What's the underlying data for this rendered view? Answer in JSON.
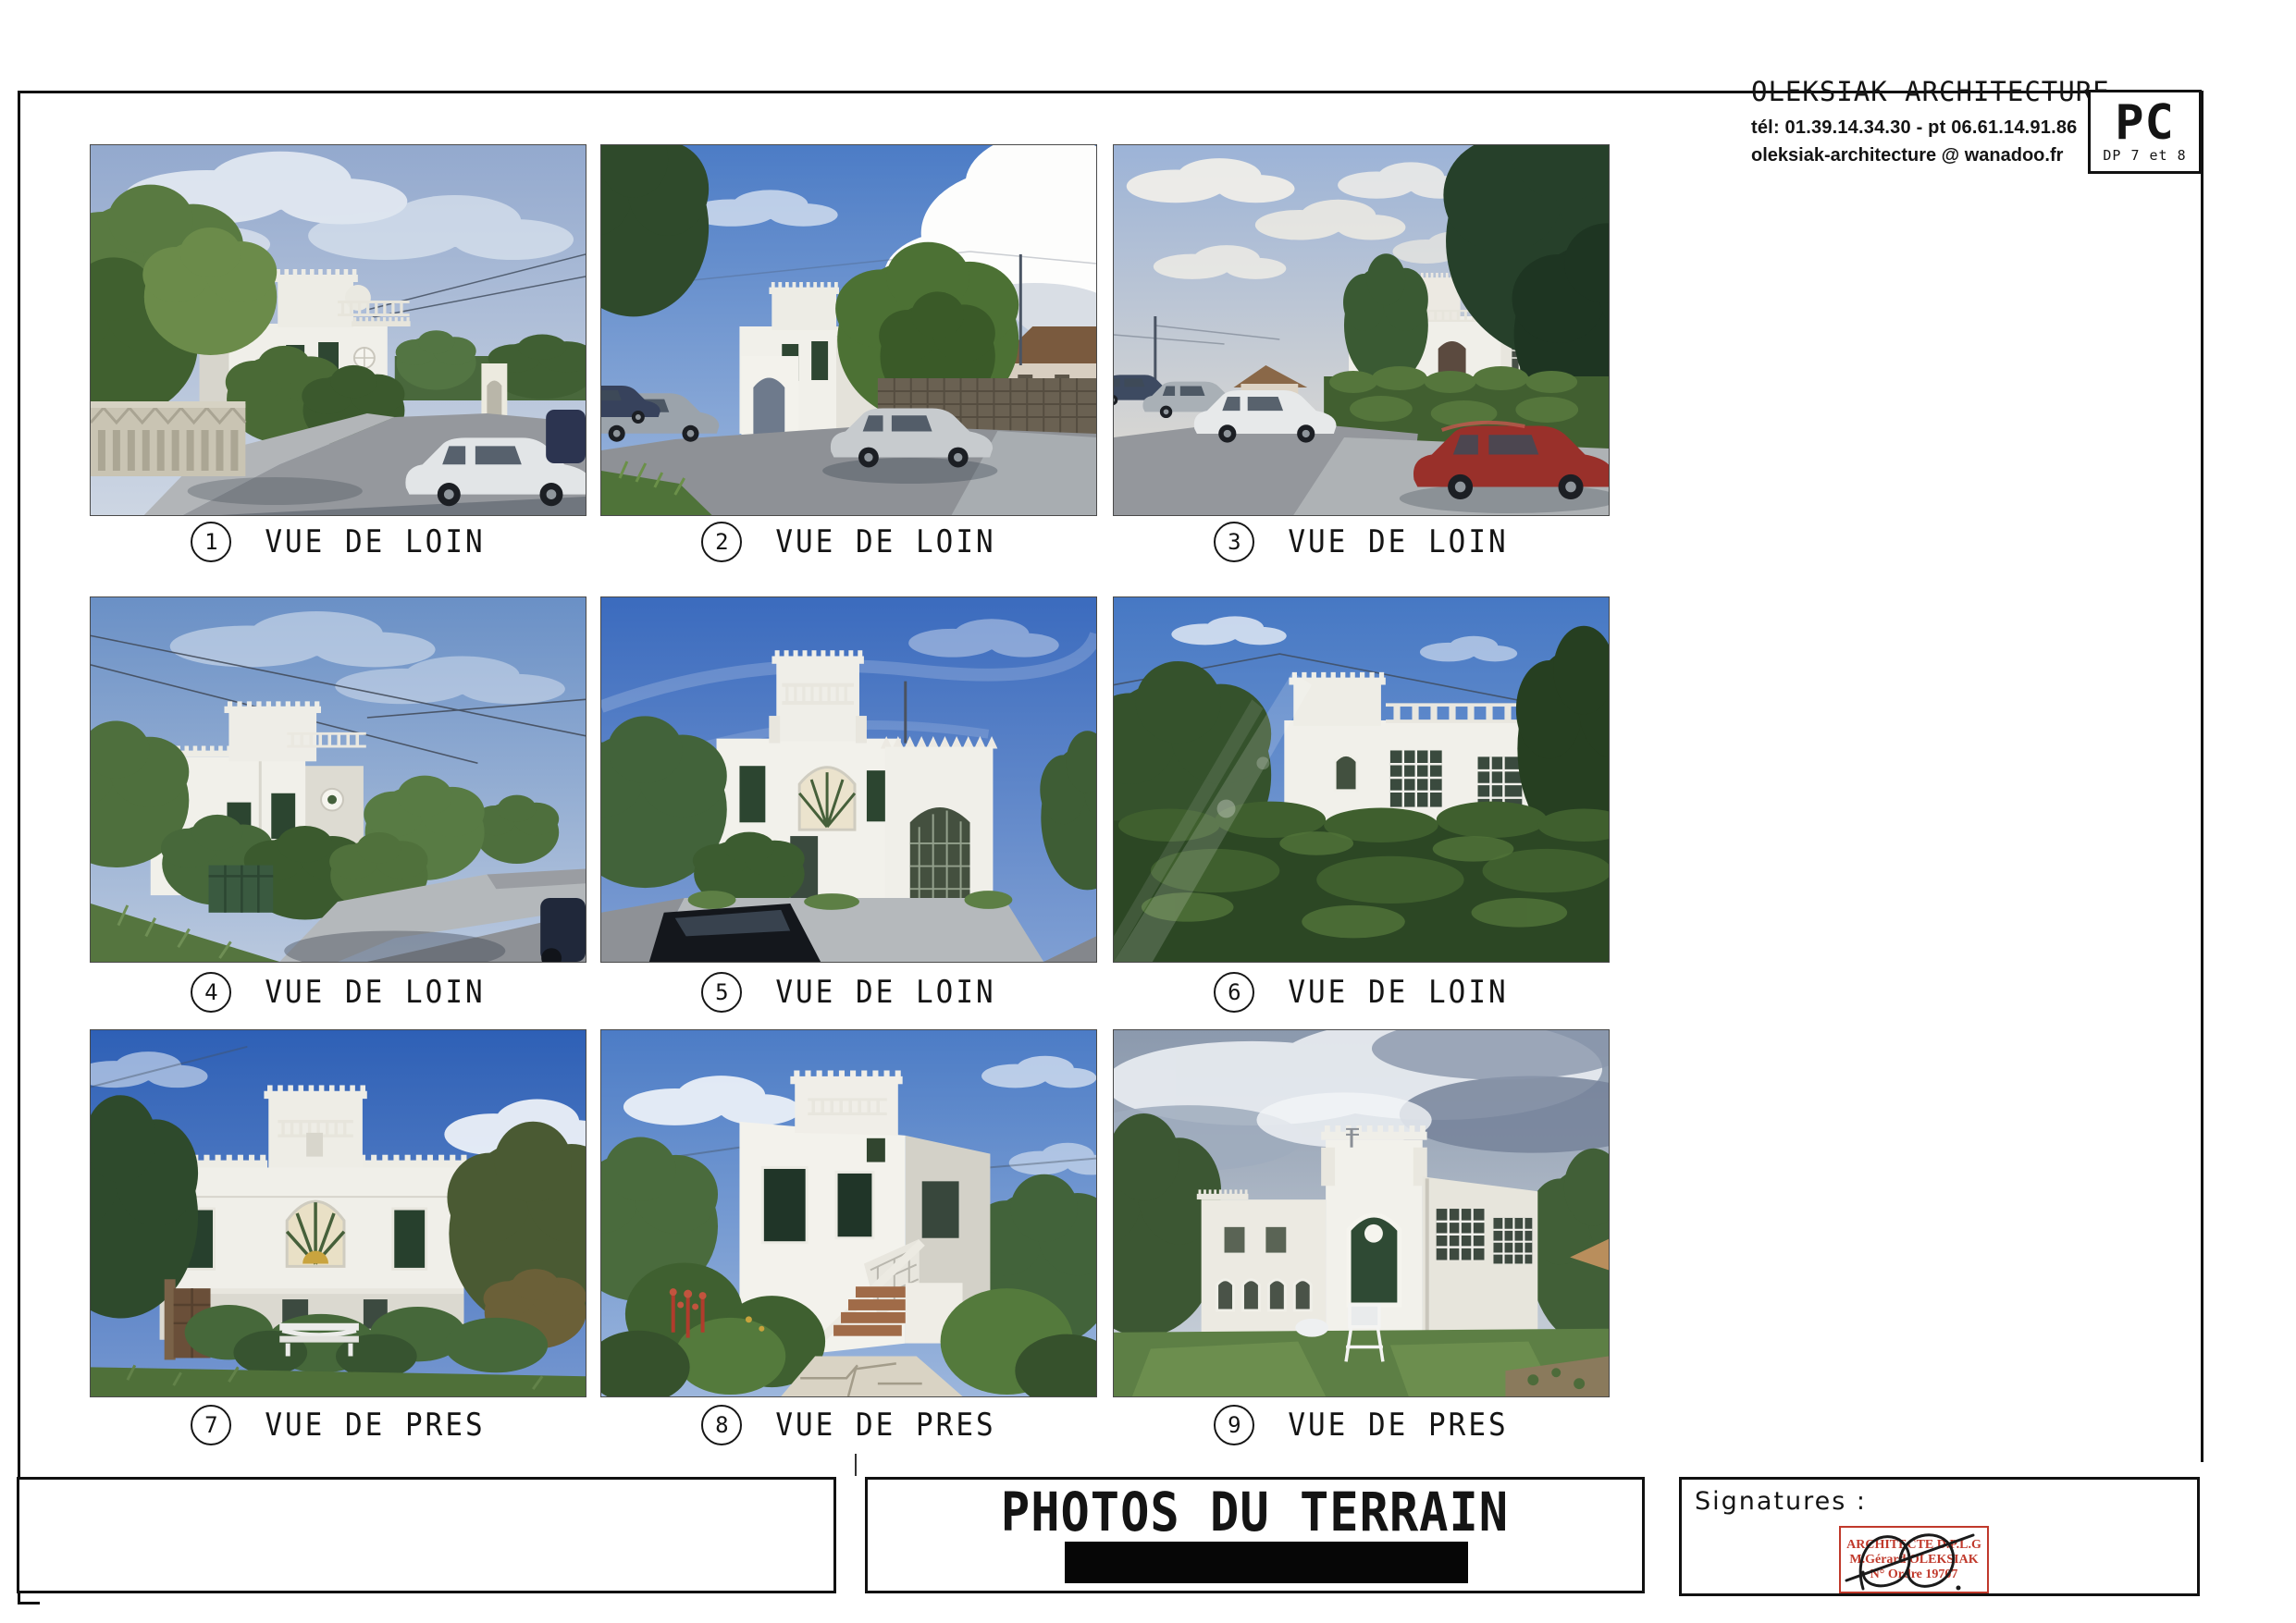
{
  "header": {
    "firm": "OLEKSIAK ARCHITECTURE",
    "phone": "tél: 01.39.14.34.30 - pt 06.61.14.91.86",
    "email": "oleksiak-architecture @ wanadoo.fr",
    "doc_code": "PC",
    "doc_sub": "DP 7 et 8"
  },
  "photos": [
    {
      "number": "1",
      "caption": "VUE DE LOIN",
      "description": "Distant street view: white crenellated Moorish villa behind fruit trees, concrete balustrade fence, road with white car at right"
    },
    {
      "number": "2",
      "caption": "VUE DE LOIN",
      "description": "Distant view: villa and arched gate at left, large green tree, silver hatchback parked, big white cumulus cloud, neighbouring houses"
    },
    {
      "number": "3",
      "caption": "VUE DE LOIN",
      "description": "Distant view down the street: parked cars at left, red car at right, villa behind tall green hedge, dark tree at top right"
    },
    {
      "number": "4",
      "caption": "VUE DE LOIN",
      "description": "Distant corner view: white villa with green door and shutters, bushes, green gate, sidewalk and road at right"
    },
    {
      "number": "5",
      "caption": "VUE DE LOIN",
      "description": "Distant view: villa with tall crenellated tower and large white arched gateway, sidewalk, dark car hood at bottom left"
    },
    {
      "number": "6",
      "caption": "VUE DE LOIN",
      "description": "Distant view: villa roofline with balustrade above massive ivy-covered hedge, lens flare from bottom left"
    },
    {
      "number": "7",
      "caption": "VUE DE PRES",
      "description": "Close frontal view: white facade with central fan window, green shutters, garden with white bench, deep blue sky"
    },
    {
      "number": "8",
      "caption": "VUE DE PRES",
      "description": "Close angled view: white villa with external staircase and white balustrade, lush garden with red flowers, stone path"
    },
    {
      "number": "9",
      "caption": "VUE DE PRES",
      "description": "Close rear view: white walls with arched green door and wrought-iron windows, lawn with white garden chair, overcast sky"
    }
  ],
  "footer": {
    "title": "PHOTOS DU TERRAIN",
    "signatures_label": "Signatures :",
    "stamp": {
      "line1": "ARCHITECTE D.P.L.G",
      "line2": "M.Gérard OLEKSIAK",
      "line3": "N° Ordre 19707"
    }
  },
  "colors": {
    "stamp_red": "#c0392b",
    "ink": "#141414"
  }
}
